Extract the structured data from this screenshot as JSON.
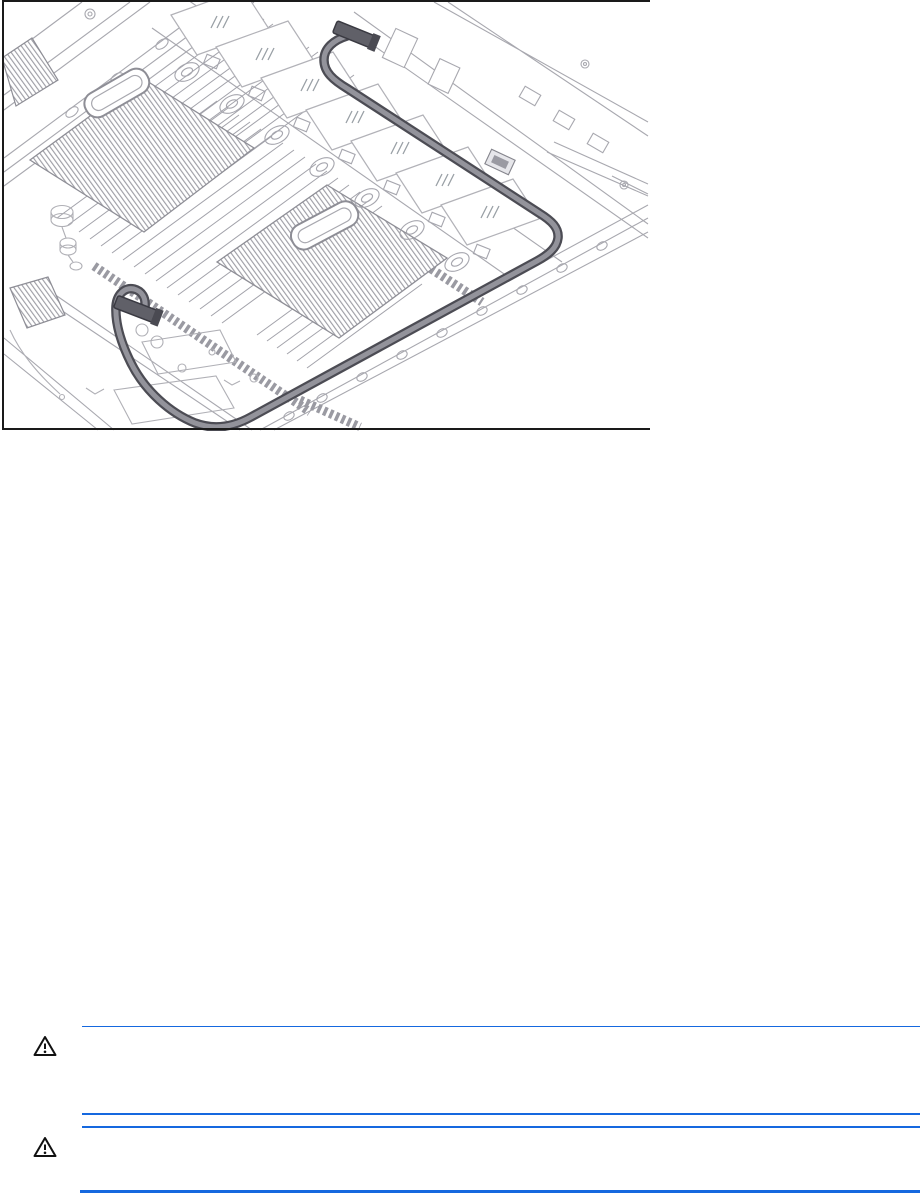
{
  "page": {
    "kind": "document-page",
    "background": "#ffffff"
  },
  "figure": {
    "name": "server-cable-routing-illustration",
    "alt": "Isometric line drawing of a server tray interior (heatsinks, DIMM banks, drive bays) with a dark cable routed from a rear connector along the board edge to a front connector loop"
  },
  "notices": [
    {
      "id": 1,
      "icon": "warning-triangle-icon",
      "text": ""
    },
    {
      "id": 2,
      "icon": "warning-triangle-icon",
      "text": ""
    }
  ],
  "colors": {
    "rule_blue": "#1568df",
    "icon_stroke": "#111111",
    "figure_border": "#1a1a1a",
    "art_line": "#a8a8af",
    "cable_dark": "#4c4c54",
    "cable_light": "#93939b"
  }
}
